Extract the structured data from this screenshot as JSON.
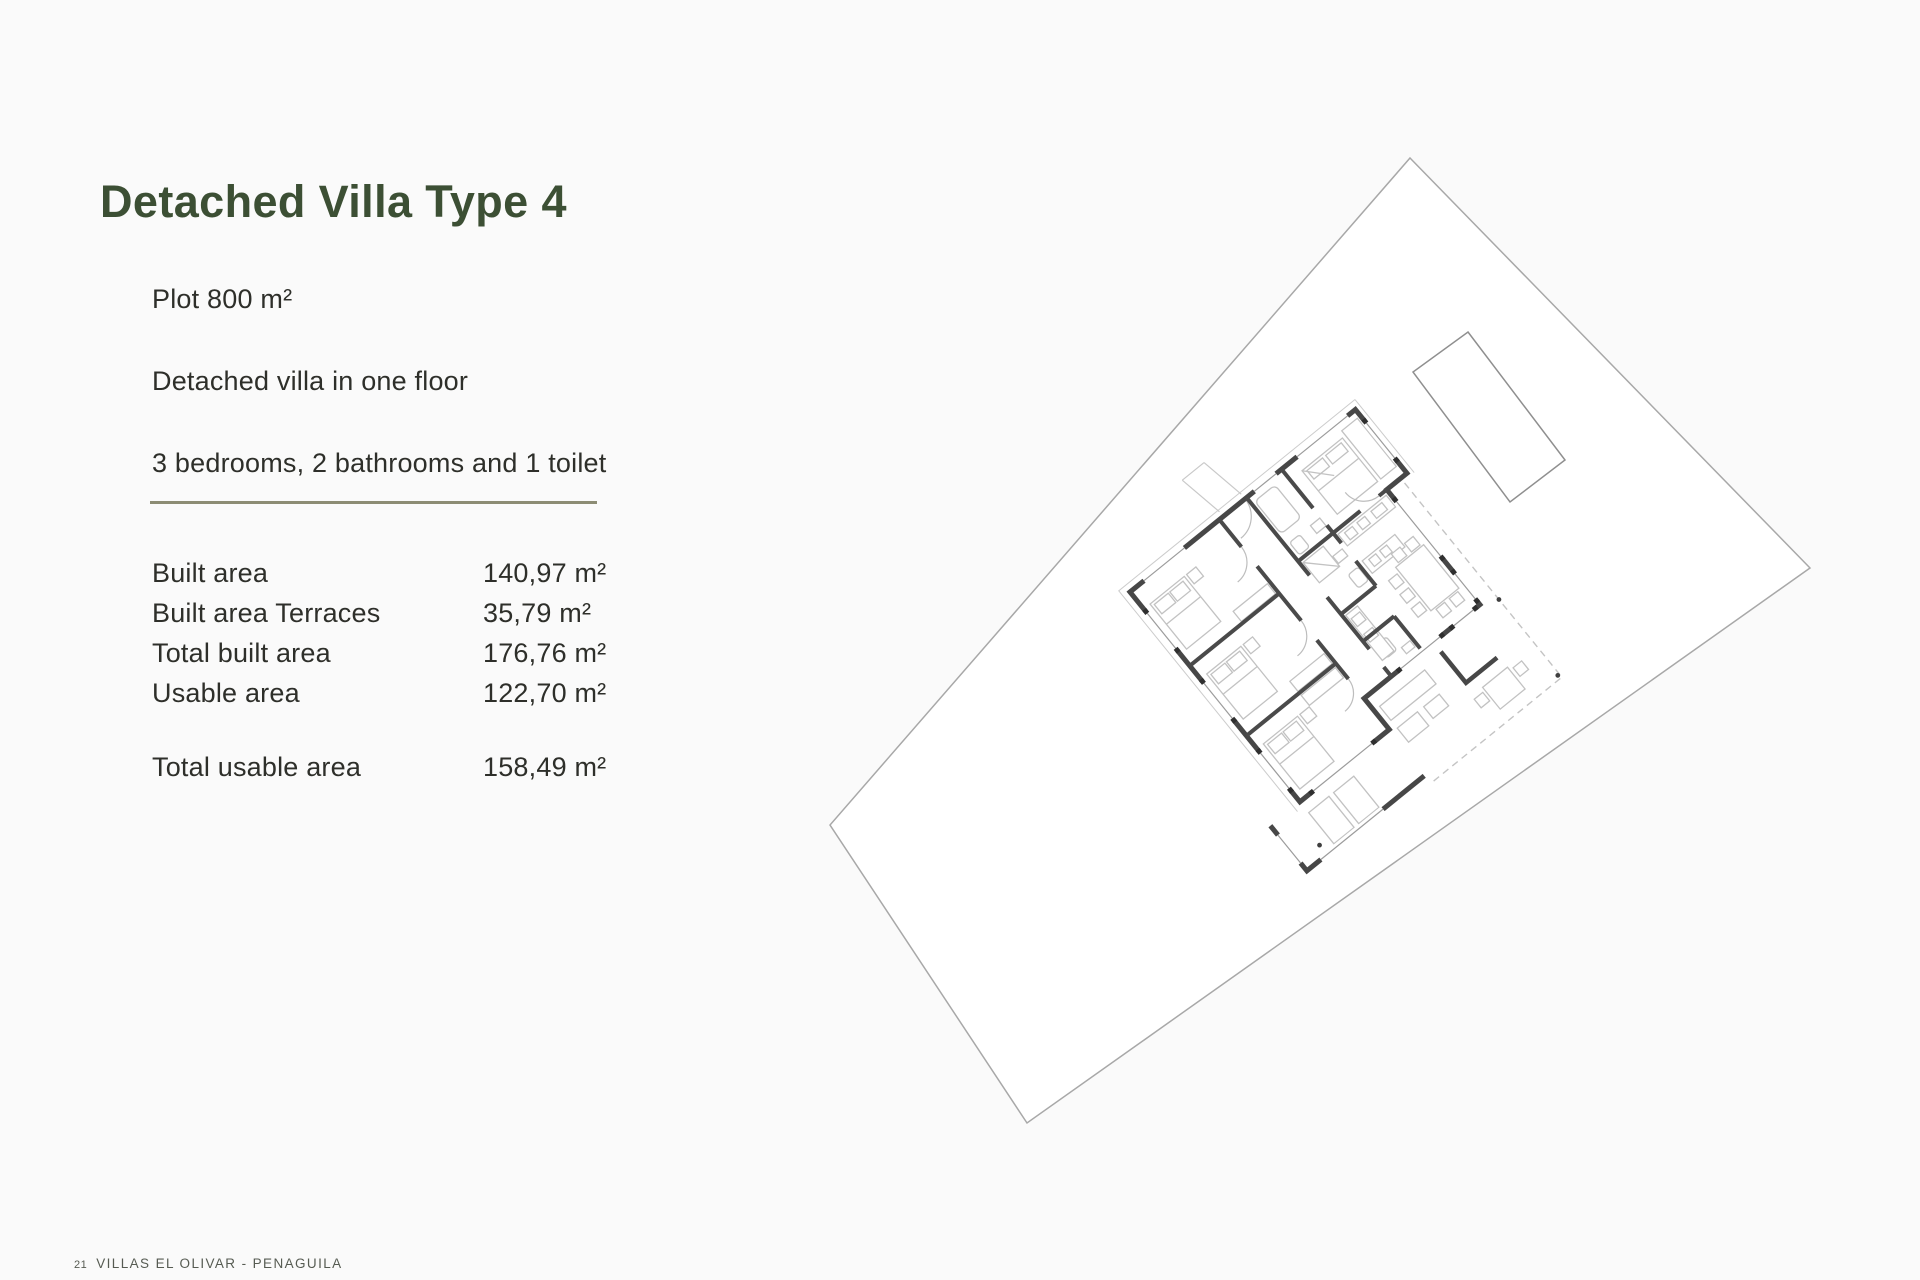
{
  "page": {
    "title": "Detached Villa Type 4",
    "specs": {
      "plot": "Plot 800 m²",
      "floors": "Detached villa in one floor",
      "rooms": "3 bedrooms, 2 bathrooms and 1 toilet"
    },
    "areas": {
      "rows": [
        {
          "label": "Built area",
          "value": "140,97 m²"
        },
        {
          "label": "Built area Terraces",
          "value": "35,79 m²"
        },
        {
          "label": "Total built area",
          "value": "176,76 m²"
        },
        {
          "label": "Usable area",
          "value": "122,70 m²"
        }
      ],
      "total": {
        "label": "Total usable area",
        "value": "158,49 m²"
      }
    },
    "footer": {
      "page_number": "21",
      "project_name": "VILLAS EL OLIVAR - PENAGUILA"
    },
    "plan": {
      "description": "Rotated site plan of a one-floor detached villa inside its plot boundary",
      "features": [
        "plot-boundary",
        "swimming-pool",
        "villa-floor-plan",
        "terrace-dashed-outline",
        "entry-walkway"
      ]
    },
    "colors": {
      "title_green": "#3c4f34",
      "body_text": "#2e2f2a",
      "divider": "#8c8c74",
      "footer_text": "#565b52",
      "wall": "#474747",
      "plan_furniture": "#c2c2c2",
      "plot_line": "#a8a8a8",
      "pool_line": "#8f8f8f"
    }
  }
}
